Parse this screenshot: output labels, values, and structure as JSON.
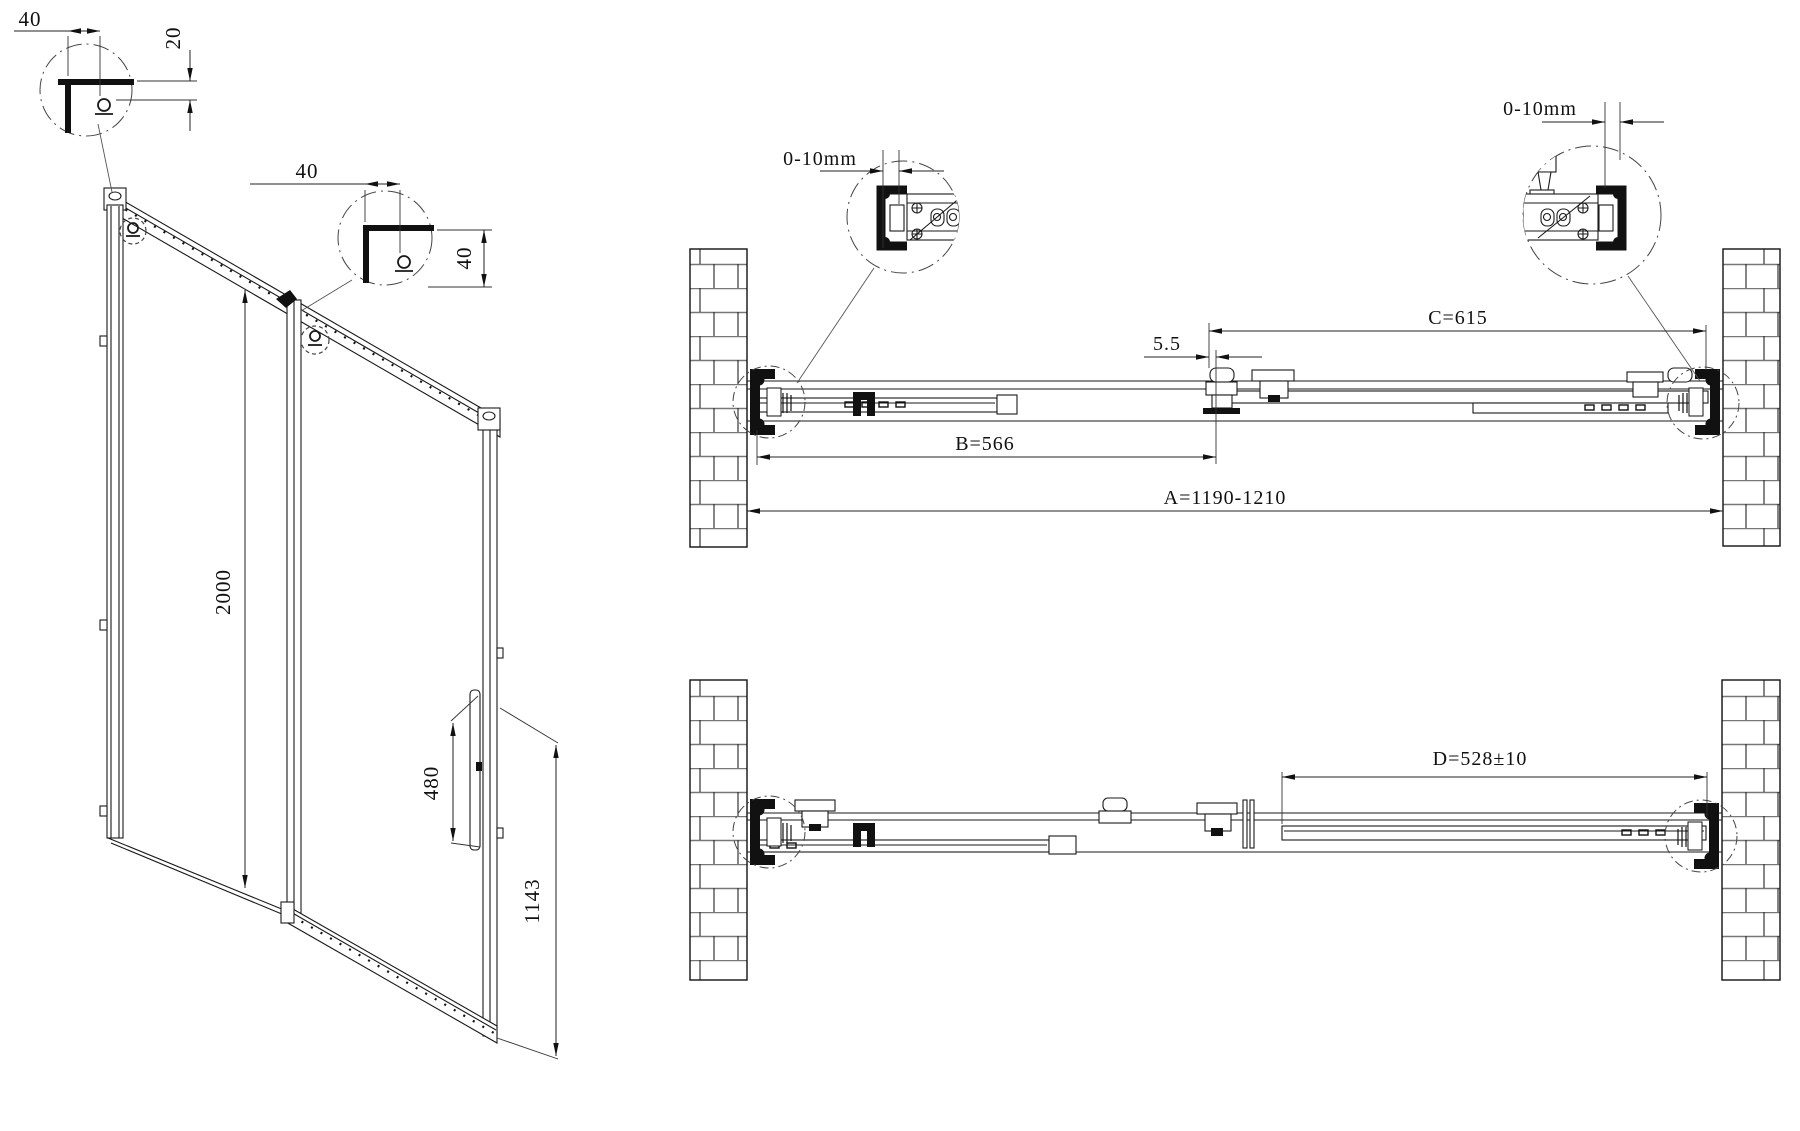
{
  "isometric": {
    "detail_corner_top": {
      "width_mm": "40",
      "height_mm": "20"
    },
    "detail_corner_mid": {
      "width_mm": "40",
      "height_mm": "40"
    },
    "door_height_mm": "2000",
    "handle_length_mm": "480",
    "handle_offset_mm": "1143"
  },
  "plan_top": {
    "wall_gap_left": "0-10mm",
    "wall_gap_right": "0-10mm",
    "dim_c": "C=615",
    "dim_overlap": "5.5",
    "dim_b": "B=566",
    "dim_a": "A=1190-1210"
  },
  "plan_bottom": {
    "dim_d": "D=528±10"
  }
}
